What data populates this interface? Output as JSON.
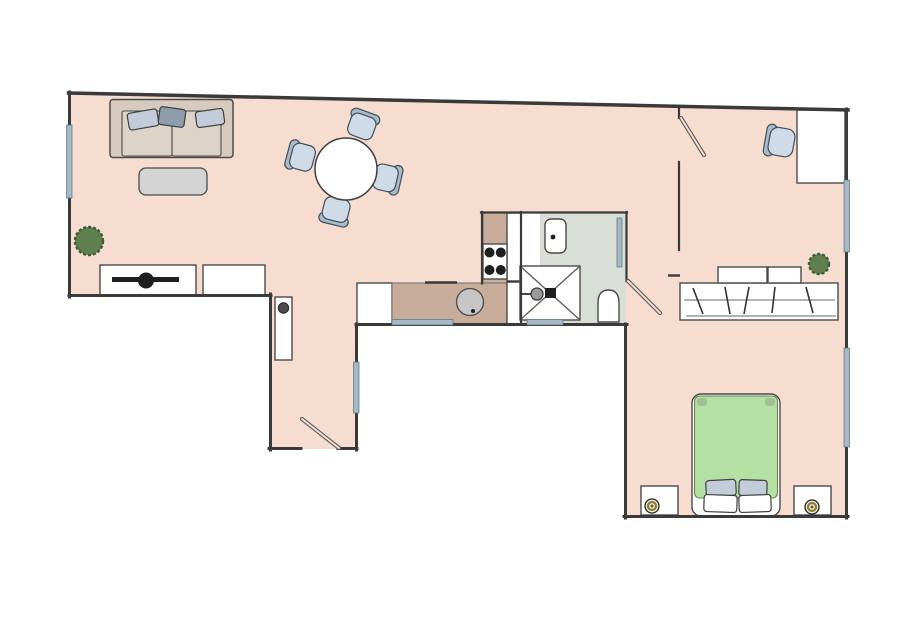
{
  "scene": {
    "type": "apartment-floor-plan",
    "rooms": [
      "living-room",
      "dining-area",
      "kitchen",
      "bathroom",
      "bedroom",
      "entry-hall"
    ],
    "furniture": [
      "sofa",
      "throw-pillows",
      "coffee-table",
      "tv-stand",
      "tv",
      "sideboard",
      "plant",
      "dining-table",
      "dining-chair",
      "hall-cabinet",
      "kitchen-counter",
      "stove",
      "kitchen-sink",
      "bathroom-counter",
      "washbasin",
      "shower",
      "shower-head",
      "radiator",
      "toilet",
      "wardrobe",
      "storage-box",
      "desk",
      "desk-chair",
      "double-bed",
      "bed-pillows",
      "nightstand",
      "table-lamp",
      "entry-door",
      "bedroom-door",
      "bathroom-door",
      "window"
    ]
  },
  "colors": {
    "background": "#ffffff",
    "floor": "#f7ddd0",
    "wall": "#3a3a3a",
    "window": "#a5b9c6",
    "counter_tan": "#c9ad9b",
    "bath_floor": "#d9ded7",
    "furniture_white": "#ffffff",
    "sofa_frame": "#d7cabf",
    "sofa_cushion": "#ded3c9",
    "pillow_light": "#c2cdd9",
    "pillow_dark": "#8e9cab",
    "table_gray": "#d4d4d4",
    "chair_seat": "#cfdbe6",
    "chair_back": "#a9bac9",
    "plant_green": "#5f7f50",
    "plant_outline": "#3c5c33",
    "bed_green": "#b5e0a3",
    "appliance_dark": "#1f1f1f",
    "sink_gray": "#c6c6c6",
    "lamp_gold": "#8f7b2e"
  }
}
